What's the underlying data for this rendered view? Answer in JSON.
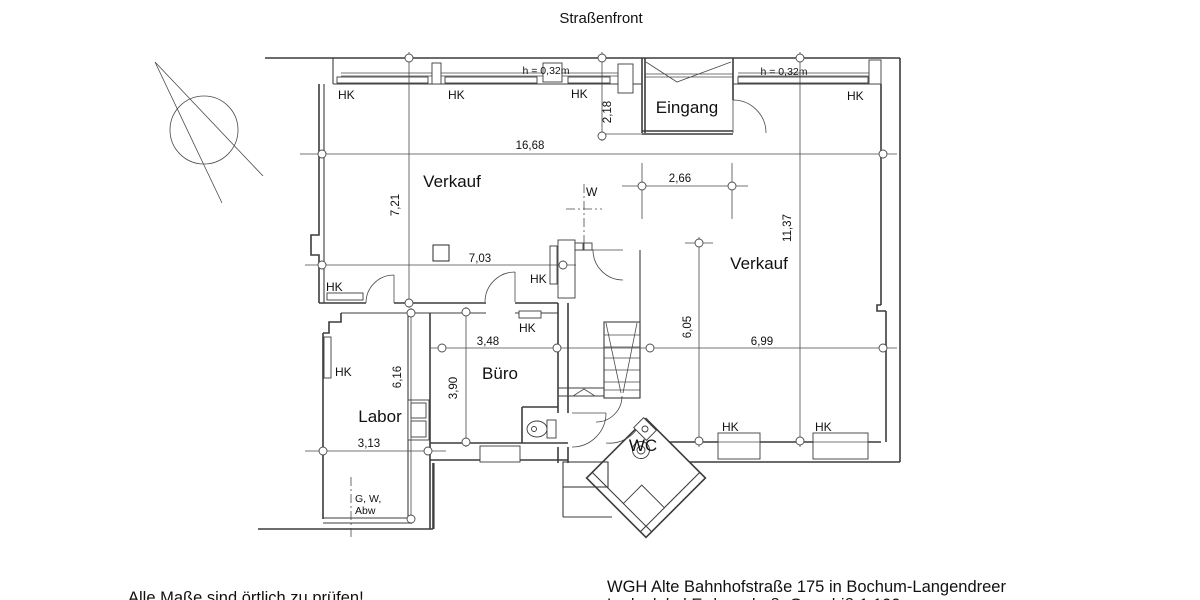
{
  "title": "Straßenfront",
  "drawing": {
    "rooms": {
      "verkauf": "Verkauf",
      "eingang": "Eingang",
      "buero": "Büro",
      "labor": "Labor",
      "wc": "WC"
    },
    "labels": {
      "hk": "HK",
      "window_height": "h = 0,32m",
      "axis_w": "W",
      "utilities_line1": "G, W,",
      "utilities_line2": "Abw"
    },
    "dimensions": {
      "front_width": "16,68",
      "entrance_depth": "2,18",
      "entrance_width": "2,66",
      "verkauf_left_depth": "7,21",
      "right_depth": "11,37",
      "verkauf_left_width": "7,03",
      "stair_depth": "6,05",
      "verkauf_right_width": "6,99",
      "buero_width": "3,48",
      "buero_depth": "3,90",
      "labor_depth": "6,16",
      "labor_width": "3,13"
    }
  },
  "footer": {
    "note": "Alle Maße sind örtlich zu prüfen!",
    "project_line1": "WGH Alte Bahnhofstraße 175 in Bochum-Langendreer",
    "project_line2": "Ladenlokal Erdgeschoß, Grundriß 1:100"
  }
}
